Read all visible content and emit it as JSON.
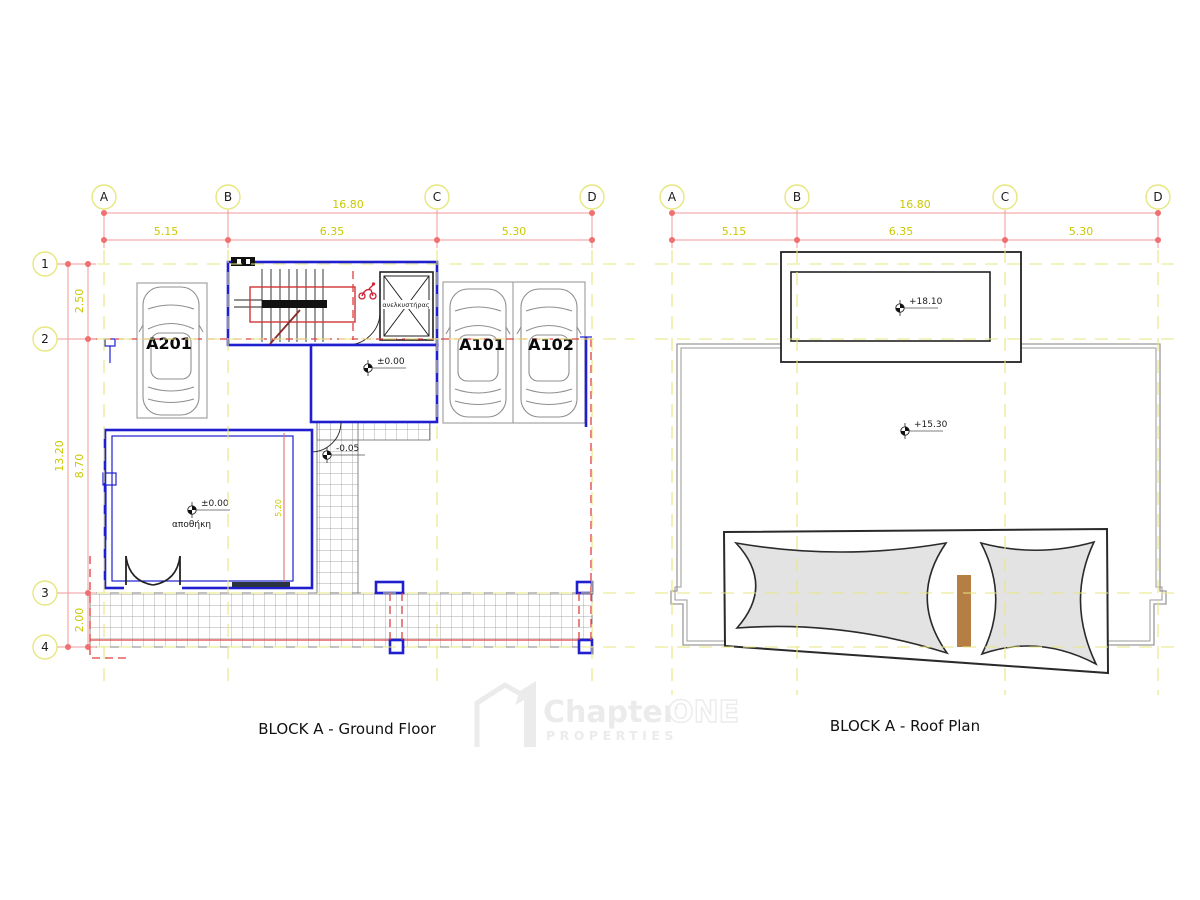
{
  "colors": {
    "wall": "#1f1fd0",
    "dim_line": "#f09a9a",
    "dim_dot": "#ee7070",
    "dim_text": "#c9c900",
    "grid_dash": "#e7e77f",
    "red_dash": "#dd4040",
    "dark": "#222222",
    "gray_line": "#9a9a9a",
    "pillow_fill": "#e3e3e3",
    "wood": "#b57e45",
    "watermark": "#ebebeb",
    "tile_line": "#8f8f8f"
  },
  "ground_floor": {
    "caption": "BLOCK A - Ground Floor",
    "grid_cols": [
      "A",
      "B",
      "C",
      "D"
    ],
    "grid_rows": [
      "1",
      "2",
      "3",
      "4"
    ],
    "dims": {
      "total_w": "16.80",
      "seg_ab": "5.15",
      "seg_bc": "6.35",
      "seg_cd": "5.30",
      "total_h": "13.20",
      "seg_12": "2.50",
      "seg_23": "8.70",
      "seg_34": "2.00",
      "storage_len": "5.20"
    },
    "units": {
      "a201": "A201",
      "a101": "A101",
      "a102": "A102"
    },
    "levels": {
      "entry": "±0.00",
      "storage": "±0.00",
      "outside": "-0.05"
    },
    "rooms": {
      "storage": "αποθήκη",
      "elevator": "ανελκυστήρας"
    }
  },
  "roof": {
    "caption": "BLOCK A - Roof Plan",
    "grid_cols": [
      "A",
      "B",
      "C",
      "D"
    ],
    "dims": {
      "total_w": "16.80",
      "seg_ab": "5.15",
      "seg_bc": "6.35",
      "seg_cd": "5.30"
    },
    "levels": {
      "bulkhead": "+18.10",
      "roof": "+15.30"
    }
  },
  "watermark": {
    "brand": "Chapter",
    "brand2": "ONE",
    "sub": "PROPERTIES"
  }
}
